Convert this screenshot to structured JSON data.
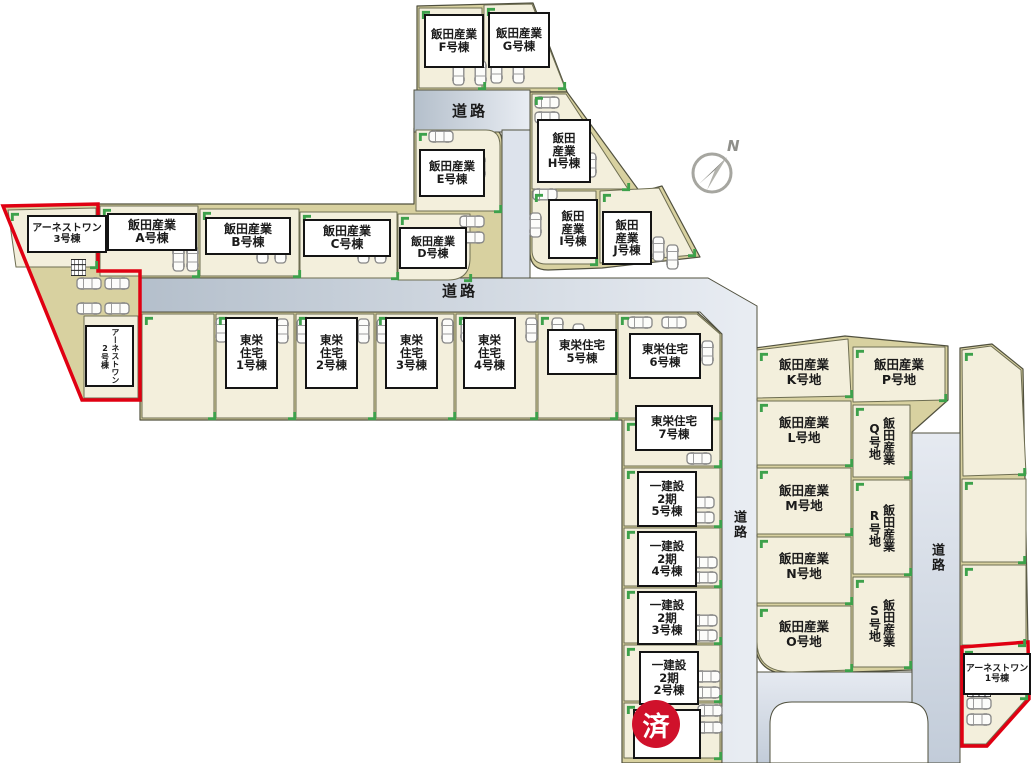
{
  "map": {
    "road_label_top": "道路",
    "road_label_middle": "道路",
    "road_label_mid_vertical": "道路",
    "road_label_right_vertical": "道路",
    "compass_n": "N",
    "sold_badge": "済",
    "colors": {
      "land": "#d8d1a0",
      "lot": "#f3efdc",
      "road_start": "#b4bfcb",
      "road_end": "#e9edf3",
      "road_v_start": "#e6eaf1",
      "road_v_end": "#c2ccd9",
      "red_outline": "#e00012",
      "corner_mark": "#3da14b",
      "sold_red": "#d0112b"
    },
    "houses": [
      {
        "id": "iida-f",
        "label": "飯田産業\nF号棟"
      },
      {
        "id": "iida-g",
        "label": "飯田産業\nG号棟"
      },
      {
        "id": "iida-e",
        "label": "飯田産業\nE号棟"
      },
      {
        "id": "iida-h",
        "label": "飯田\n産業\nH号棟"
      },
      {
        "id": "iida-i",
        "label": "飯田\n産業\nI号棟"
      },
      {
        "id": "iida-j",
        "label": "飯田\n産業\nJ号棟"
      },
      {
        "id": "arnest-3",
        "label": "アーネストワン\n3号棟"
      },
      {
        "id": "iida-a",
        "label": "飯田産業\nA号棟"
      },
      {
        "id": "iida-b",
        "label": "飯田産業\nB号棟"
      },
      {
        "id": "iida-c",
        "label": "飯田産業\nC号棟"
      },
      {
        "id": "iida-d",
        "label": "飯田産業\nD号棟"
      },
      {
        "id": "arnest-2",
        "label": "アーネストワン\n2号棟"
      },
      {
        "id": "toei-1",
        "label": "東栄\n住宅\n1号棟"
      },
      {
        "id": "toei-2",
        "label": "東栄\n住宅\n2号棟"
      },
      {
        "id": "toei-3",
        "label": "東栄\n住宅\n3号棟"
      },
      {
        "id": "toei-4",
        "label": "東栄\n住宅\n4号棟"
      },
      {
        "id": "toei-5",
        "label": "東栄住宅\n5号棟"
      },
      {
        "id": "toei-6",
        "label": "東栄住宅\n6号棟"
      },
      {
        "id": "toei-7",
        "label": "東栄住宅\n7号棟"
      },
      {
        "id": "hajime-5",
        "label": "一建設\n2期\n5号棟"
      },
      {
        "id": "hajime-4",
        "label": "一建設\n2期\n4号棟"
      },
      {
        "id": "hajime-3",
        "label": "一建設\n2期\n3号棟"
      },
      {
        "id": "hajime-2",
        "label": "一建設\n2期\n2号棟"
      },
      {
        "id": "arnest-1",
        "label": "アーネストワン\n1号棟"
      }
    ],
    "parcels": [
      {
        "id": "iida-k",
        "label": "飯田産業\nK号地"
      },
      {
        "id": "iida-l",
        "label": "飯田産業\nL号地"
      },
      {
        "id": "iida-m",
        "label": "飯田産業\nM号地"
      },
      {
        "id": "iida-n",
        "label": "飯田産業\nN号地"
      },
      {
        "id": "iida-o",
        "label": "飯田産業\nO号地"
      },
      {
        "id": "iida-p",
        "label": "飯田産業\nP号地"
      },
      {
        "id": "iida-q",
        "label": "飯田産業\nQ号地"
      },
      {
        "id": "iida-r",
        "label": "飯田産業\nR号地"
      },
      {
        "id": "iida-s",
        "label": "飯田産業\nS号地"
      }
    ]
  }
}
